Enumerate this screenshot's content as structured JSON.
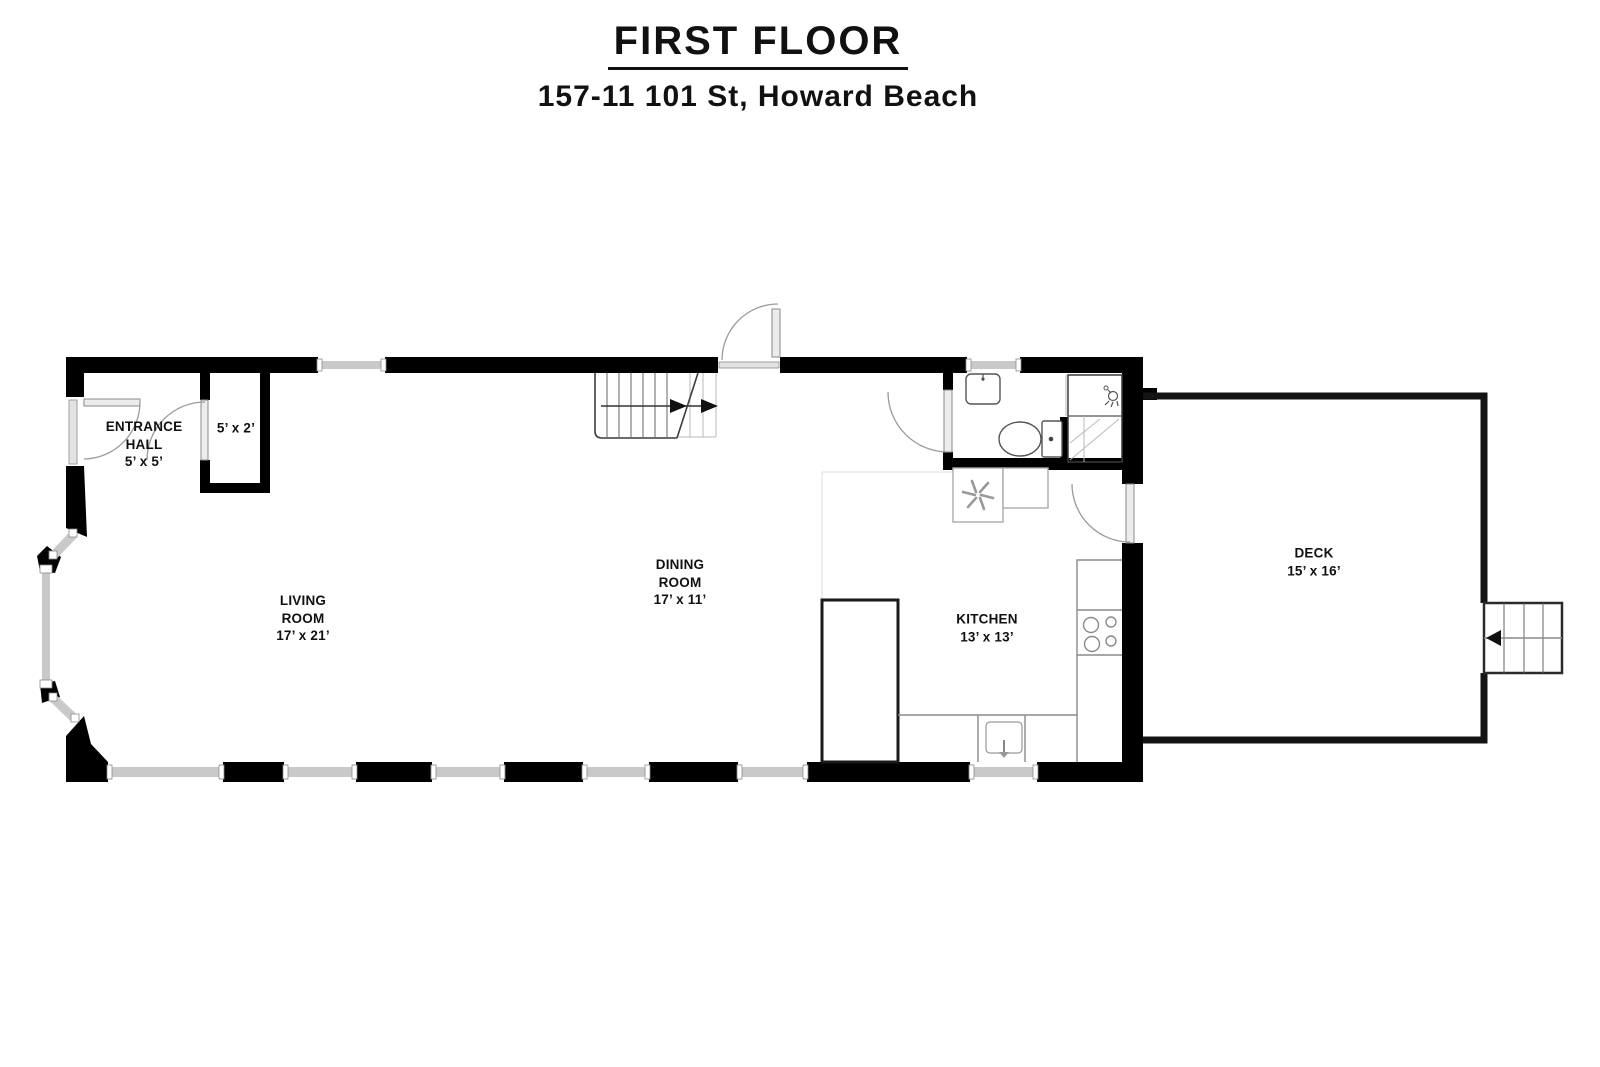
{
  "title": "FIRST FLOOR",
  "subtitle": "157-11 101 St, Howard Beach",
  "rooms": {
    "entrance_hall": {
      "line1": "ENTRANCE",
      "line2": "HALL",
      "dims": "5’ x 5’"
    },
    "closet": {
      "dims": "5’ x 2’"
    },
    "living_room": {
      "line1": "LIVING",
      "line2": "ROOM",
      "dims": "17’ x 21’"
    },
    "dining_room": {
      "line1": "DINING",
      "line2": "ROOM",
      "dims": "17’ x 11’"
    },
    "kitchen": {
      "line1": "KITCHEN",
      "dims": "13’ x 13’"
    },
    "deck": {
      "line1": "DECK",
      "dims": "15’ x 16’"
    }
  },
  "colors": {
    "background": "#ffffff",
    "text": "#111111",
    "wall": "#000000",
    "window_fill": "#c9c9c9",
    "frame_line": "#8a8a8a",
    "door_arc": "#9a9a9a",
    "faint_line": "#dddddd",
    "deck_outline": "#141414"
  }
}
